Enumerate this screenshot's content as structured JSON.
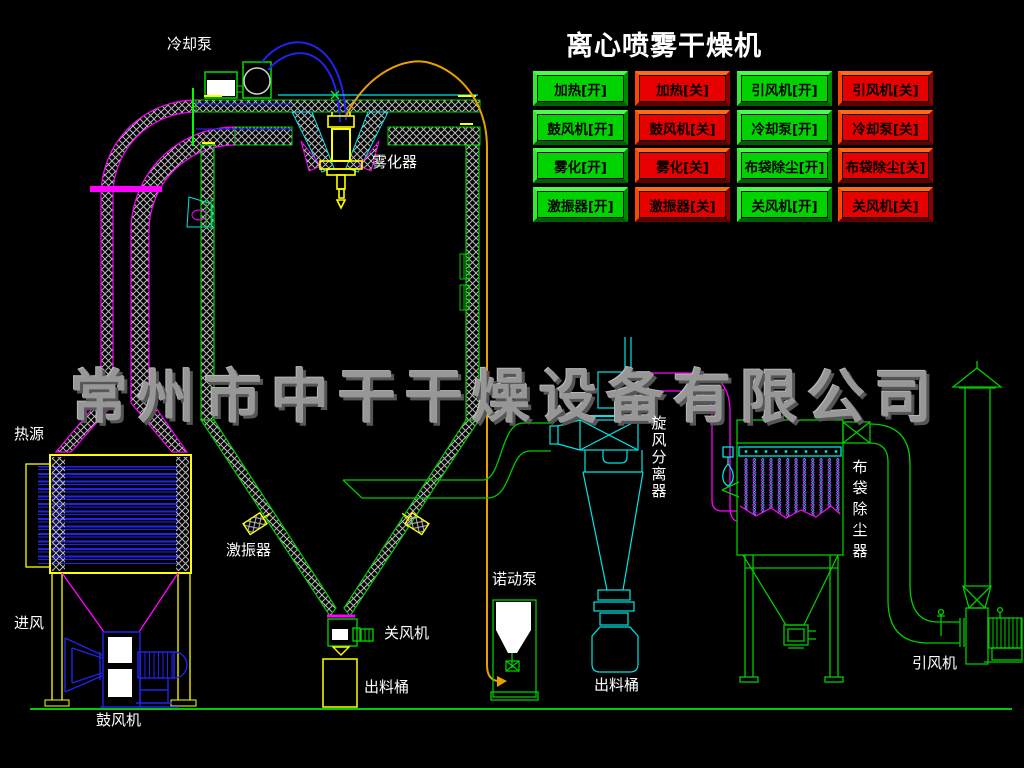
{
  "title": "离心喷雾干燥机",
  "watermark": "常州市中干干燥设备有限公司",
  "buttons": [
    {
      "id": "heat-on",
      "label": "加热[开]",
      "state": "on"
    },
    {
      "id": "heat-off",
      "label": "加热[关]",
      "state": "off"
    },
    {
      "id": "id-fan-on",
      "label": "引风机[开]",
      "state": "on"
    },
    {
      "id": "id-fan-off",
      "label": "引风机[关]",
      "state": "off"
    },
    {
      "id": "blower-on",
      "label": "鼓风机[开]",
      "state": "on"
    },
    {
      "id": "blower-off",
      "label": "鼓风机[关]",
      "state": "off"
    },
    {
      "id": "cooling-pump-on",
      "label": "冷却泵[开]",
      "state": "on"
    },
    {
      "id": "cooling-pump-off",
      "label": "冷却泵[关]",
      "state": "off"
    },
    {
      "id": "atomize-on",
      "label": "雾化[开]",
      "state": "on"
    },
    {
      "id": "atomize-off",
      "label": "雾化[关]",
      "state": "off"
    },
    {
      "id": "bag-filter-on",
      "label": "布袋除尘[开]",
      "state": "on"
    },
    {
      "id": "bag-filter-off",
      "label": "布袋除尘[关]",
      "state": "off"
    },
    {
      "id": "vibrator-on",
      "label": "激振器[开]",
      "state": "on"
    },
    {
      "id": "vibrator-off",
      "label": "激振器[关]",
      "state": "off"
    },
    {
      "id": "rotary-valve-on",
      "label": "关风机[开]",
      "state": "on"
    },
    {
      "id": "rotary-valve-off",
      "label": "关风机[关]",
      "state": "off"
    }
  ],
  "labels": {
    "cooling_pump": "冷却泵",
    "atomizer": "雾化器",
    "heat_source": "热源",
    "air_inlet": "进风",
    "blower": "鼓风机",
    "vibrator": "激振器",
    "rotary_valve": "关风机",
    "chamber_discharge_bucket": "出料桶",
    "peristaltic_pump": "诺动泵",
    "cyclone_separator": "旋风分离器",
    "cyclone_discharge_bucket": "出料桶",
    "bag_filter": "布袋除尘器",
    "induced_draft_fan": "引风机"
  },
  "colors": {
    "background": "#000000",
    "button_on_face": "#00d300",
    "button_off_face": "#e60000",
    "title_text": "#ffffff",
    "label_text": "#ffffff",
    "watermark_text": "#979797",
    "line_green": "#00cc00",
    "line_bright_green": "#00ff00",
    "line_cyan": "#00e5e5",
    "line_magenta": "#ff00ff",
    "line_blue": "#2222ee",
    "line_yellow": "#ffff00",
    "line_orange": "#e8a000",
    "hatch_gray": "#b9b9b9"
  }
}
